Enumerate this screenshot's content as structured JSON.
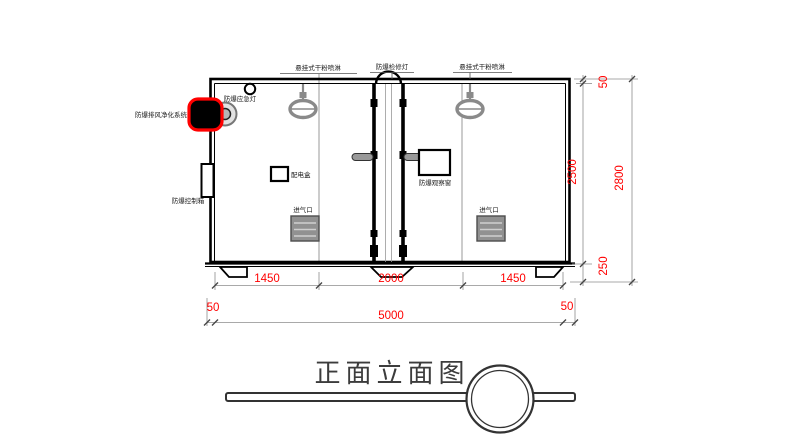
{
  "title": {
    "text": "正面立面图"
  },
  "labels": {
    "sprinkler_left": "悬挂式干粉喷淋",
    "inspection_lamp": "防爆检修灯",
    "sprinkler_right": "悬挂式干粉喷淋",
    "emergency_lamp": "防爆应急灯",
    "purification_system": "防爆排风净化系统",
    "control_box": "防爆控制箱",
    "power_box": "配电盒",
    "observation_window": "防爆观察窗",
    "air_inlet_left": "进气口",
    "air_inlet_right": "进气口"
  },
  "dimensions": {
    "bottom_row": [
      "1450",
      "2000",
      "1450"
    ],
    "width_row": [
      "50",
      "5000",
      "50"
    ],
    "height_right": {
      "top": "50",
      "inner": "2500",
      "foot": "250",
      "total": "2800"
    }
  },
  "colors": {
    "dimension_text": "#ff0000",
    "highlight_outline": "#ff0000",
    "line": "#000000",
    "gray_part": "#8a8a8a"
  }
}
